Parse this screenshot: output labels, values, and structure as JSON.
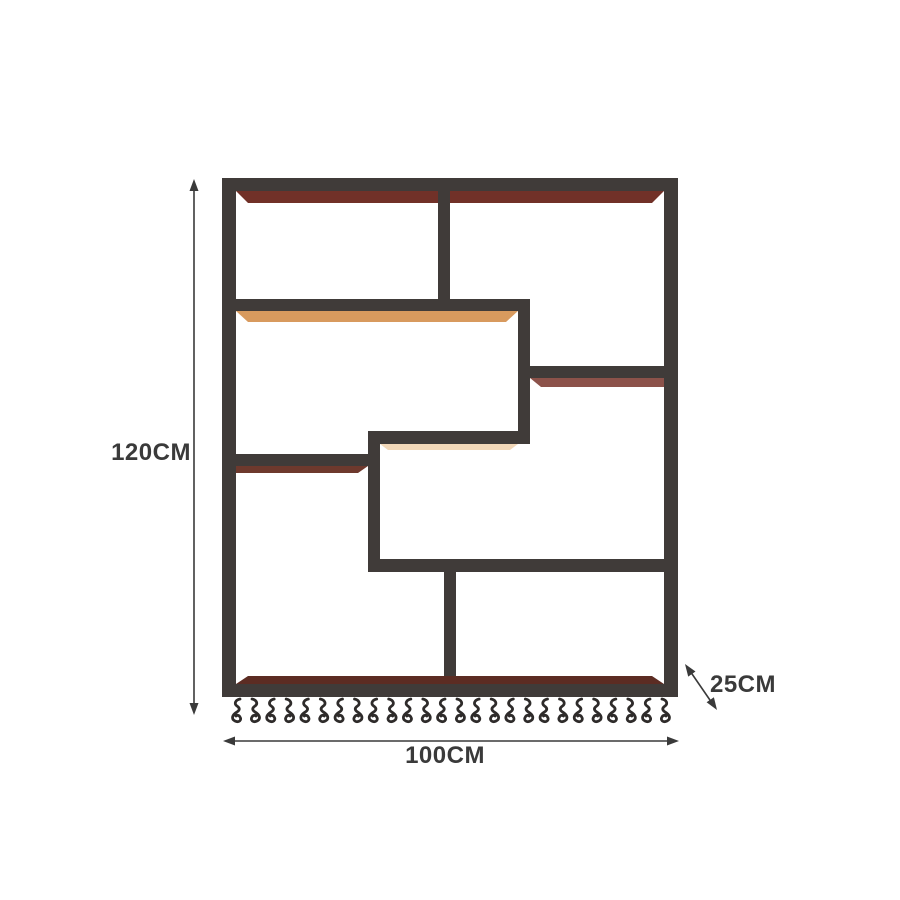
{
  "diagram": {
    "kind": "product-dimension-diagram",
    "product": "wall-mounted-wine-rack-shelf",
    "dimensions": {
      "height": {
        "label": "120CM"
      },
      "width": {
        "label": "100CM"
      },
      "depth": {
        "label": "25CM"
      }
    },
    "colors": {
      "background": "#ffffff",
      "frame": "#403b39",
      "frame_dark": "#2e2b2a",
      "wood_top": "#713128",
      "wood_tan": "#d89a5e",
      "wood_red": "#8c524a",
      "wood_left": "#6e392d",
      "wood_bottom": "#5c2c23",
      "under_glow": "#eec9a0",
      "annotation": "#3a3a3a"
    },
    "hangers": {
      "count": 13,
      "hooks_per_unit": 2
    }
  }
}
